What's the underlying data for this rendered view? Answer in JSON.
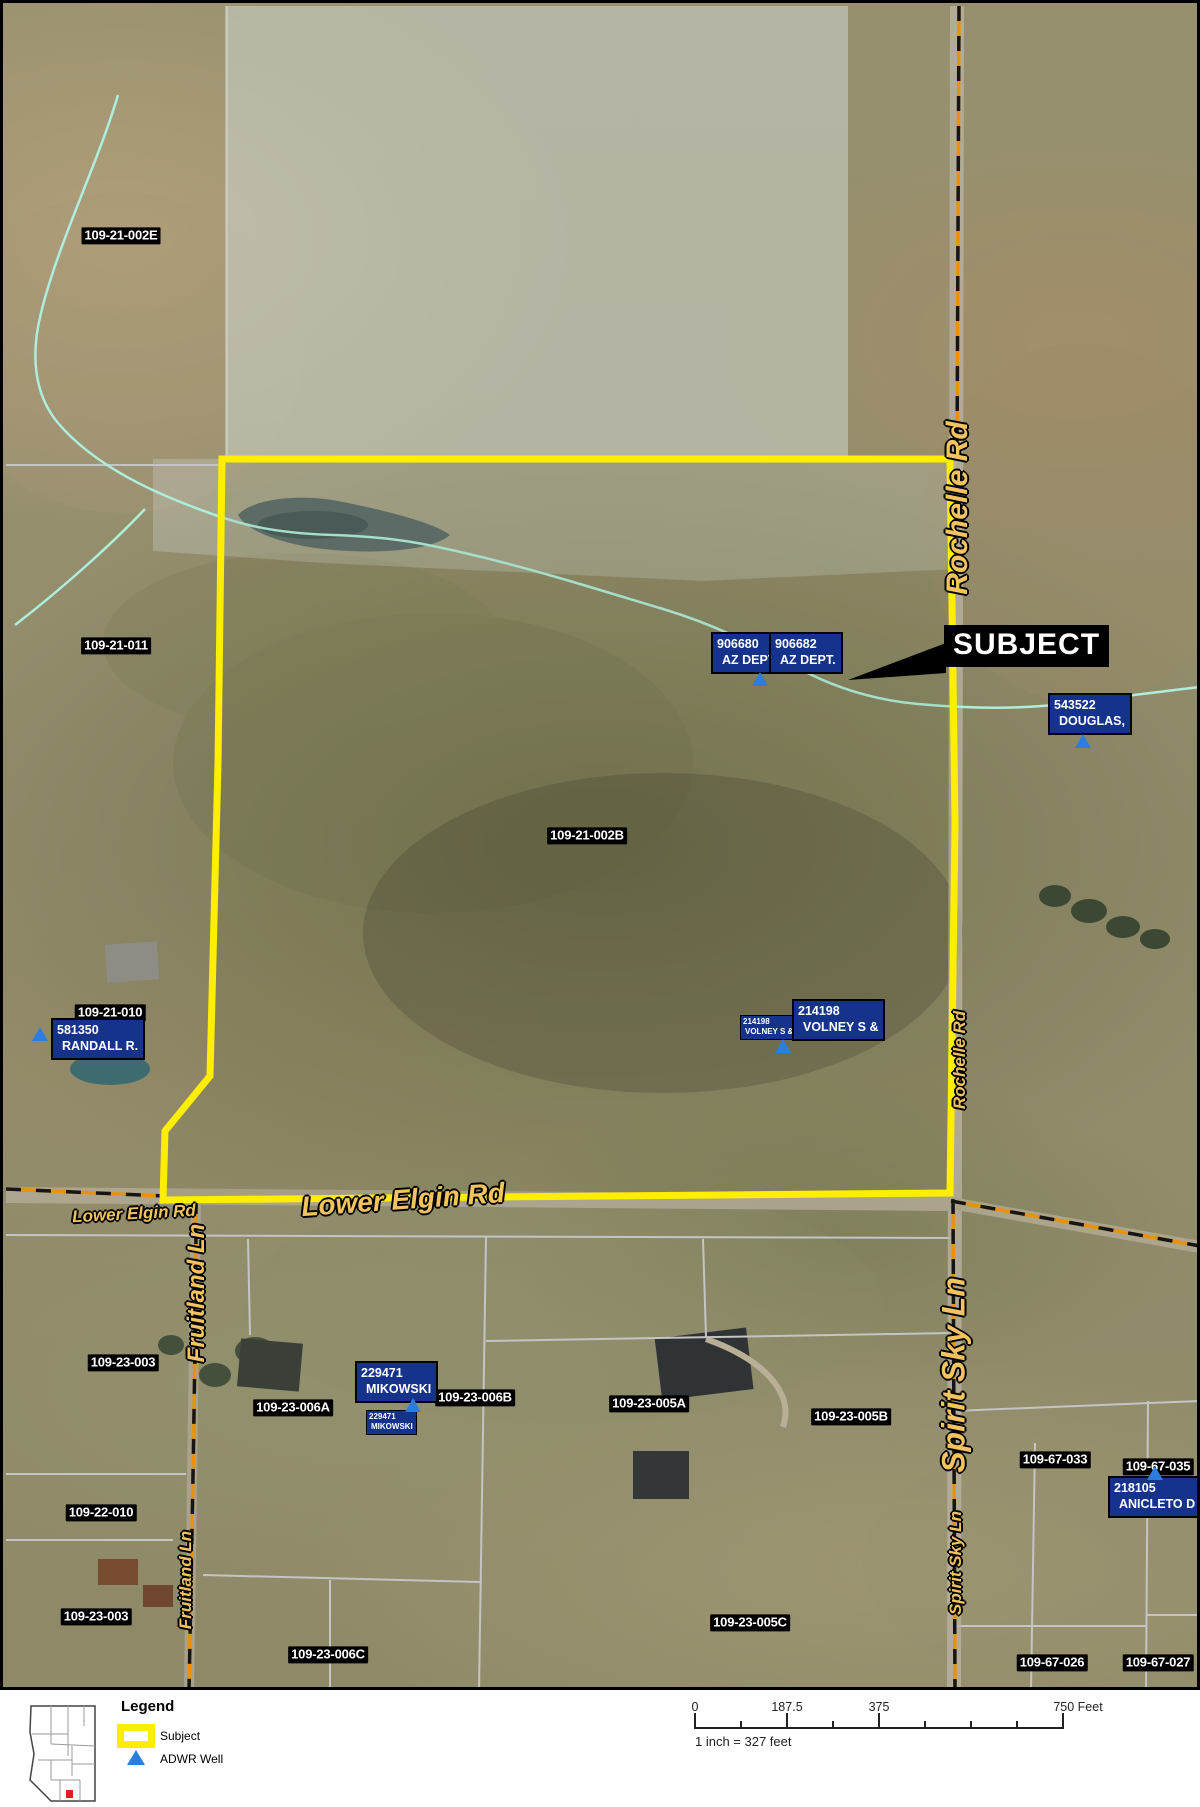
{
  "map": {
    "parcel_labels": [
      {
        "text": "109-21-002E",
        "x": 118,
        "y": 233
      },
      {
        "text": "109-21-011",
        "x": 113,
        "y": 643
      },
      {
        "text": "109-21-002B",
        "x": 584,
        "y": 833
      },
      {
        "text": "109-21-010",
        "x": 107,
        "y": 1010
      },
      {
        "text": "109-23-003",
        "x": 120,
        "y": 1360
      },
      {
        "text": "109-23-006A",
        "x": 290,
        "y": 1405
      },
      {
        "text": "109-23-006B",
        "x": 472,
        "y": 1395
      },
      {
        "text": "109-23-005A",
        "x": 646,
        "y": 1401
      },
      {
        "text": "109-23-005B",
        "x": 848,
        "y": 1414
      },
      {
        "text": "109-67-033",
        "x": 1052,
        "y": 1457
      },
      {
        "text": "109-67-035",
        "x": 1155,
        "y": 1464
      },
      {
        "text": "109-22-010",
        "x": 98,
        "y": 1510
      },
      {
        "text": "109-23-003",
        "x": 93,
        "y": 1614
      },
      {
        "text": "109-23-006C",
        "x": 325,
        "y": 1652
      },
      {
        "text": "109-23-005C",
        "x": 747,
        "y": 1620
      },
      {
        "text": "109-67-026",
        "x": 1049,
        "y": 1660
      },
      {
        "text": "109-67-027",
        "x": 1155,
        "y": 1660
      }
    ],
    "owner_labels": [
      {
        "line1": "906680",
        "line2": "AZ DEPT.",
        "x": 708,
        "y": 629,
        "small": false
      },
      {
        "line1": "906682",
        "line2": "AZ DEPT.",
        "x": 766,
        "y": 629,
        "small": false
      },
      {
        "line1": "543522",
        "line2": "DOUGLAS,",
        "x": 1045,
        "y": 690,
        "small": false
      },
      {
        "line1": "581350",
        "line2": "RANDALL R.",
        "x": 48,
        "y": 1015,
        "small": false
      },
      {
        "line1": "214198",
        "line2": "VOLNEY S &",
        "x": 737,
        "y": 1012,
        "small": true
      },
      {
        "line1": "214198",
        "line2": "VOLNEY S &",
        "x": 789,
        "y": 996,
        "small": false
      },
      {
        "line1": "229471",
        "line2": "MIKOWSKI",
        "x": 352,
        "y": 1358,
        "small": false
      },
      {
        "line1": "229471",
        "line2": "MIKOWSKI",
        "x": 363,
        "y": 1407,
        "small": true
      },
      {
        "line1": "218105",
        "line2": "ANICLETO D",
        "x": 1105,
        "y": 1473,
        "small": false
      }
    ],
    "wells": [
      {
        "x": 757,
        "y": 676
      },
      {
        "x": 1080,
        "y": 738
      },
      {
        "x": 37,
        "y": 1031
      },
      {
        "x": 780,
        "y": 1043
      },
      {
        "x": 410,
        "y": 1402
      },
      {
        "x": 1152,
        "y": 1470
      }
    ],
    "road_labels": [
      {
        "text": "Rochelle Rd",
        "x": 955,
        "y": 505,
        "rot": -90,
        "size": 30
      },
      {
        "text": "Rochelle Rd",
        "x": 957,
        "y": 1057,
        "rot": -90,
        "size": 17
      },
      {
        "text": "Lower Elgin Rd",
        "x": 400,
        "y": 1197,
        "rot": -4,
        "size": 28
      },
      {
        "text": "Lower Elgin Rd",
        "x": 131,
        "y": 1211,
        "rot": -3,
        "size": 17
      },
      {
        "text": "Fruitland Ln",
        "x": 194,
        "y": 1290,
        "rot": -90,
        "size": 24
      },
      {
        "text": "Fruitland Ln",
        "x": 183,
        "y": 1577,
        "rot": -90,
        "size": 17
      },
      {
        "text": "Spirit Sky Ln",
        "x": 951,
        "y": 1372,
        "rot": -90,
        "size": 32
      },
      {
        "text": "Spirit Sky Ln",
        "x": 953,
        "y": 1560,
        "rot": -90,
        "size": 17
      }
    ],
    "subject_callout": {
      "text": "SUBJECT"
    }
  },
  "legend": {
    "title": "Legend",
    "subject_label": "Subject",
    "well_label": "ADWR Well"
  },
  "scalebar": {
    "labels": [
      {
        "text": "0",
        "x": 695
      },
      {
        "text": "187.5",
        "x": 787
      },
      {
        "text": "375",
        "x": 879
      },
      {
        "text": "750 Feet",
        "x": 1078
      }
    ],
    "ticks": [
      695,
      741,
      787,
      833,
      879,
      925,
      971,
      1017,
      1063
    ],
    "major": [
      695,
      787,
      879,
      1063
    ],
    "note": "1 inch = 327 feet"
  },
  "colors": {
    "subject_outline": "#ffee00",
    "well_blue": "#2b7de0",
    "owner_box_bg": "#16338c",
    "road_label_yellow": "#f2c35f",
    "road_dash_orange": "#e8920a",
    "stream_cyan": "#aeeedd",
    "parcel_line_grey": "#c4c4c4",
    "inset_dot_red": "#e02020"
  }
}
